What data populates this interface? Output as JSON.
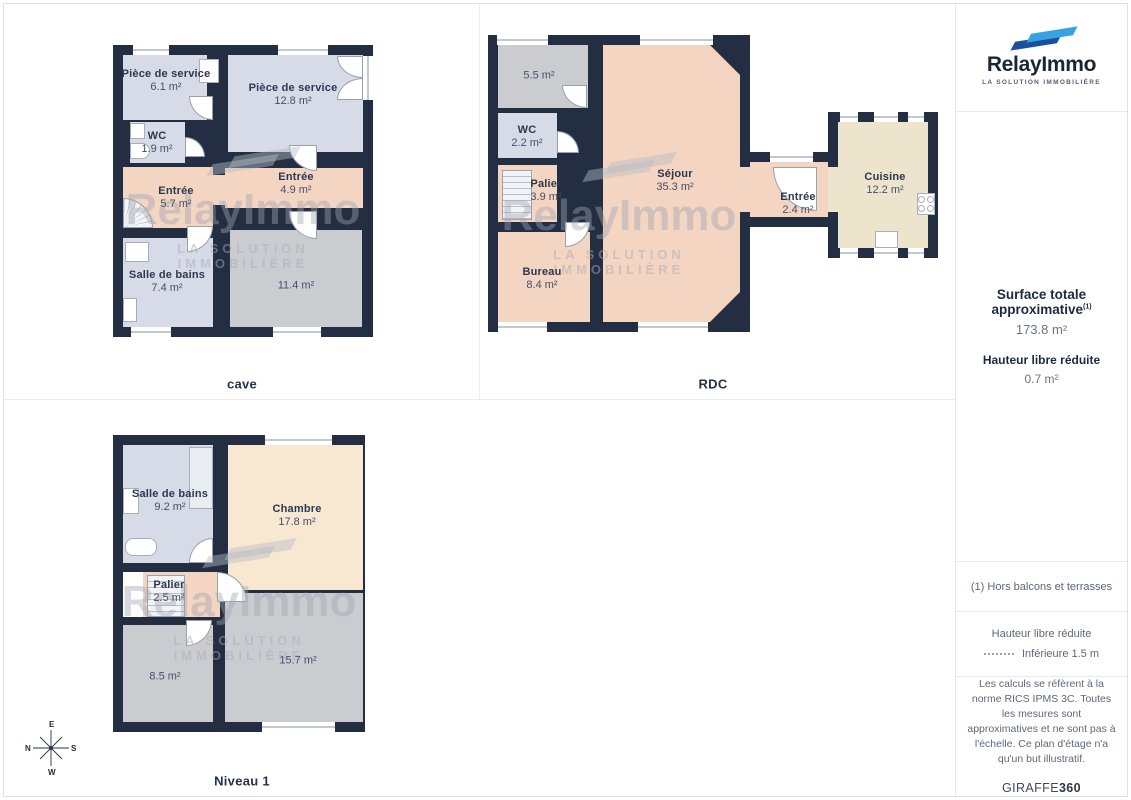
{
  "branding": {
    "name": "RelayImmo",
    "tagline": "LA SOLUTION IMMOBILIÈRE",
    "colors": {
      "blue_dark": "#1c4f9e",
      "blue_light": "#35a2e2",
      "wall": "#232e42",
      "room_blue": "#d6dbe7",
      "room_peach": "#f4d5c2",
      "room_gray": "#cbccd0",
      "room_cream": "#f9e8d1",
      "room_khaki": "#ece4cd"
    }
  },
  "plans": [
    {
      "caption": "cave",
      "rooms": [
        {
          "name": "Pièce de service",
          "area": "6.1 m²"
        },
        {
          "name": "Pièce de service",
          "area": "12.8 m²"
        },
        {
          "name": "WC",
          "area": "1.9 m²"
        },
        {
          "name": "Entrée",
          "area": "5.7 m²"
        },
        {
          "name": "Entrée",
          "area": "4.9 m²"
        },
        {
          "name": "Salle de bains",
          "area": "7.4 m²"
        },
        {
          "name": "",
          "area": "11.4 m²"
        }
      ]
    },
    {
      "caption": "RDC",
      "rooms": [
        {
          "name": "",
          "area": "5.5 m²"
        },
        {
          "name": "WC",
          "area": "2.2 m²"
        },
        {
          "name": "Palier",
          "area": "3.9 m²"
        },
        {
          "name": "Séjour",
          "area": "35.3 m²"
        },
        {
          "name": "Bureau",
          "area": "8.4 m²"
        },
        {
          "name": "Entrée",
          "area": "2.4 m²"
        },
        {
          "name": "Cuisine",
          "area": "12.2 m²"
        }
      ]
    },
    {
      "caption": "Niveau 1",
      "rooms": [
        {
          "name": "Salle de bains",
          "area": "9.2 m²"
        },
        {
          "name": "Chambre",
          "area": "17.8 m²"
        },
        {
          "name": "Palier",
          "area": "2.5 m²"
        },
        {
          "name": "",
          "area": "8.5 m²"
        },
        {
          "name": "",
          "area": "15.7 m²"
        }
      ]
    }
  ],
  "sidebar": {
    "summary_title": "Surface totale approximative",
    "summary_sup": "(1)",
    "summary_value": "173.8 m²",
    "reduced_title": "Hauteur libre réduite",
    "reduced_value": "0.7 m²",
    "note": "(1) Hors balcons et terrasses",
    "legend_title": "Hauteur libre réduite",
    "legend_item": "Inférieure 1.5 m",
    "disclaimer": "Les calculs se réfèrent à la norme RICS IPMS 3C. Toutes les mesures sont approximatives et ne sont pas à l'échelle. Ce plan d'étage n'a qu'un but illustratif.",
    "footer_brand": "GIRAFFE",
    "footer_brand_bold": "360"
  },
  "compass": {
    "top": "E",
    "left": "N",
    "right": "S",
    "bottom": "W"
  }
}
